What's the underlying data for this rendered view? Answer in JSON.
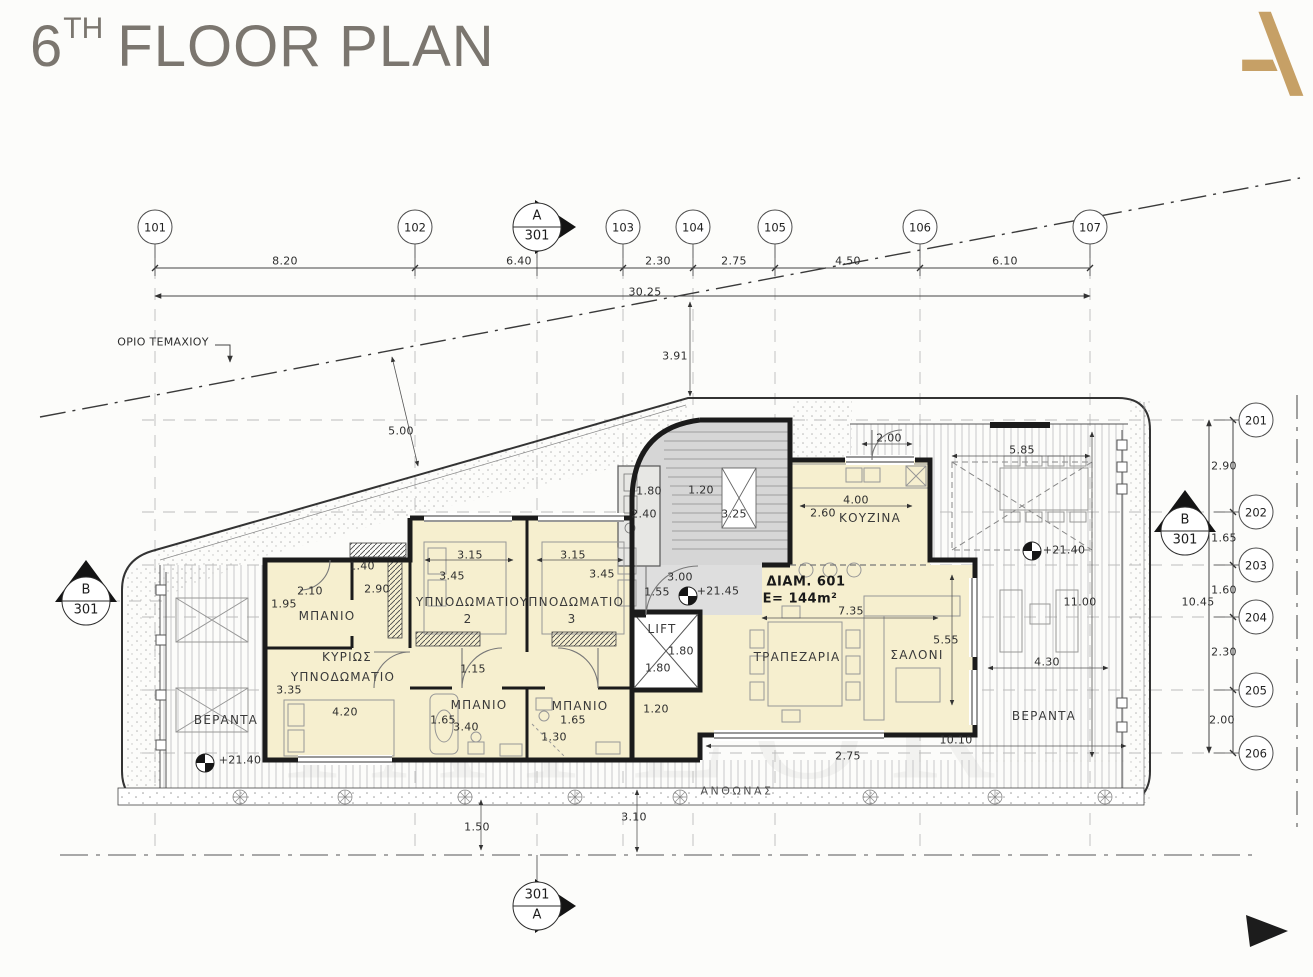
{
  "title": {
    "number": "6",
    "ordinal": "TH",
    "rest": "FLOOR PLAN"
  },
  "logo": {
    "letter": "A",
    "color": "#c6a066"
  },
  "colors": {
    "room_fill": "#f6efcf",
    "stair_fill": "#d6d6d6",
    "wall": "#1b1b1b",
    "accent_gold": "#c6a066",
    "title_gray": "#7b766f"
  },
  "watermark": "TAYLOR",
  "apartment": {
    "id": "ΔΙΑΜ. 601",
    "area": "E=  144m²"
  },
  "grid": {
    "top": [
      {
        "id": "101",
        "x": 155
      },
      {
        "id": "102",
        "x": 415
      },
      {
        "id": "103",
        "x": 623
      },
      {
        "id": "104",
        "x": 693
      },
      {
        "id": "105",
        "x": 775
      },
      {
        "id": "106",
        "x": 920
      },
      {
        "id": "107",
        "x": 1090
      }
    ],
    "right": [
      {
        "id": "201",
        "y": 420
      },
      {
        "id": "202",
        "y": 512
      },
      {
        "id": "203",
        "y": 565
      },
      {
        "id": "204",
        "y": 617
      },
      {
        "id": "205",
        "y": 690
      },
      {
        "id": "206",
        "y": 753
      }
    ]
  },
  "markers": [
    {
      "top": "A",
      "bottom": "301",
      "x": 537,
      "y": 227,
      "dir": "right"
    },
    {
      "top": "B",
      "bottom": "301",
      "x": 86,
      "y": 601,
      "dir": "up"
    },
    {
      "top": "B",
      "bottom": "301",
      "x": 1185,
      "y": 531,
      "dir": "up"
    },
    {
      "top": "301",
      "bottom": "A",
      "x": 537,
      "y": 906,
      "dir": "right"
    }
  ],
  "icons": {
    "plant": "flower-rosette",
    "level_mark": "quartered-circle",
    "corner_arrow": "black-triangle"
  },
  "labels": [
    {
      "t": "8.20",
      "x": 285,
      "y": 261
    },
    {
      "t": "6.40",
      "x": 519,
      "y": 261
    },
    {
      "t": "2.30",
      "x": 658,
      "y": 261
    },
    {
      "t": "2.75",
      "x": 734,
      "y": 261
    },
    {
      "t": "4.50",
      "x": 848,
      "y": 261
    },
    {
      "t": "6.10",
      "x": 1005,
      "y": 261
    },
    {
      "t": "30.25",
      "x": 645,
      "y": 292
    },
    {
      "n": "boundary-label",
      "t": "ΟΡΙΟ ΤΕΜΑΧΙΟΥ",
      "x": 163,
      "y": 342
    },
    {
      "t": "3.91",
      "x": 675,
      "y": 356
    },
    {
      "t": "5.00",
      "x": 401,
      "y": 431
    },
    {
      "t": "2.00",
      "x": 889,
      "y": 438
    },
    {
      "t": "5.85",
      "x": 1022,
      "y": 450
    },
    {
      "t": "1.80",
      "x": 649,
      "y": 491
    },
    {
      "t": "1.20",
      "x": 701,
      "y": 490
    },
    {
      "t": "2.40",
      "x": 644,
      "y": 514
    },
    {
      "t": "3.25",
      "x": 734,
      "y": 514
    },
    {
      "t": "4.00",
      "x": 856,
      "y": 500
    },
    {
      "t": "2.60",
      "x": 823,
      "y": 513
    },
    {
      "t": "ΚΟΥΖΙΝΑ",
      "x": 870,
      "y": 518,
      "k": "r"
    },
    {
      "t": "1.40",
      "x": 362,
      "y": 566
    },
    {
      "t": "3.15",
      "x": 470,
      "y": 555
    },
    {
      "t": "3.45",
      "x": 452,
      "y": 576
    },
    {
      "t": "3.15",
      "x": 573,
      "y": 555
    },
    {
      "t": "3.45",
      "x": 602,
      "y": 574
    },
    {
      "t": "2.90",
      "x": 377,
      "y": 589
    },
    {
      "t": "2.10",
      "x": 310,
      "y": 591
    },
    {
      "t": "1.95",
      "x": 284,
      "y": 604
    },
    {
      "t": "ΜΠΑΝΙΟ",
      "x": 327,
      "y": 616,
      "k": "r"
    },
    {
      "t": "3.00",
      "x": 680,
      "y": 577
    },
    {
      "t": "1.55",
      "x": 657,
      "y": 592
    },
    {
      "t": "+21.45",
      "x": 718,
      "y": 591
    },
    {
      "n": "apartment-id",
      "t": "ΔΙΑΜ. 601",
      "x": 806,
      "y": 582,
      "k": "b"
    },
    {
      "n": "apartment-area",
      "t": "E=  144m²",
      "x": 800,
      "y": 599,
      "k": "b"
    },
    {
      "t": "ΥΠΝΟΔΩΜΑΤΙΟ",
      "x": 468,
      "y": 602,
      "k": "r"
    },
    {
      "t": "2",
      "x": 468,
      "y": 619,
      "k": "r"
    },
    {
      "t": "ΥΠΝΟΔΩΜΑΤΙΟ",
      "x": 572,
      "y": 602,
      "k": "r"
    },
    {
      "t": "3",
      "x": 572,
      "y": 619,
      "k": "r"
    },
    {
      "t": "7.35",
      "x": 851,
      "y": 611
    },
    {
      "t": "5.55",
      "x": 946,
      "y": 640
    },
    {
      "t": "ΣΑΛΟΝΙ",
      "x": 917,
      "y": 655,
      "k": "r"
    },
    {
      "t": "ΤΡΑΠΕΖΑΡΙΑ",
      "x": 797,
      "y": 657,
      "k": "r"
    },
    {
      "t": "LIFT",
      "x": 662,
      "y": 629,
      "k": "r"
    },
    {
      "t": "1.80",
      "x": 681,
      "y": 651
    },
    {
      "t": "1.80",
      "x": 658,
      "y": 668
    },
    {
      "t": "ΚΥΡΙΩΣ",
      "x": 347,
      "y": 657,
      "k": "r"
    },
    {
      "t": "ΥΠΝΟΔΩΜΑΤΙΟ",
      "x": 343,
      "y": 677,
      "k": "r"
    },
    {
      "t": "3.35",
      "x": 289,
      "y": 690
    },
    {
      "t": "1.15",
      "x": 473,
      "y": 669
    },
    {
      "t": "11.00",
      "x": 1080,
      "y": 602
    },
    {
      "t": "10.45",
      "x": 1198,
      "y": 602
    },
    {
      "t": "4.30",
      "x": 1047,
      "y": 662
    },
    {
      "t": "ΒΕΡΑΝΤΑ",
      "x": 1044,
      "y": 716,
      "k": "r"
    },
    {
      "t": "4.20",
      "x": 345,
      "y": 712
    },
    {
      "t": "ΜΠΑΝΙΟ",
      "x": 479,
      "y": 705,
      "k": "r"
    },
    {
      "t": "1.65",
      "x": 443,
      "y": 720
    },
    {
      "t": "3.40",
      "x": 466,
      "y": 727
    },
    {
      "t": "ΜΠΑΝΙΟ",
      "x": 580,
      "y": 706,
      "k": "r"
    },
    {
      "t": "1.65",
      "x": 573,
      "y": 720
    },
    {
      "t": "1.30",
      "x": 554,
      "y": 737
    },
    {
      "t": "1.20",
      "x": 656,
      "y": 709
    },
    {
      "t": "2.75",
      "x": 848,
      "y": 756
    },
    {
      "t": "10.10",
      "x": 956,
      "y": 740
    },
    {
      "t": "ΒΕΡΑΝΤΑ",
      "x": 226,
      "y": 720,
      "k": "r"
    },
    {
      "t": "+21.40",
      "x": 240,
      "y": 760
    },
    {
      "t": "+21.40",
      "x": 1064,
      "y": 550
    },
    {
      "n": "planter-label",
      "t": "ΑΝΘΩΝΑΣ",
      "x": 737,
      "y": 791,
      "k": "p"
    },
    {
      "t": "1.50",
      "x": 477,
      "y": 827
    },
    {
      "t": "3.10",
      "x": 634,
      "y": 817
    },
    {
      "t": "2.90",
      "x": 1224,
      "y": 466
    },
    {
      "t": "1.65",
      "x": 1224,
      "y": 538
    },
    {
      "t": "1.60",
      "x": 1224,
      "y": 590
    },
    {
      "t": "2.30",
      "x": 1224,
      "y": 652
    },
    {
      "t": "2.00",
      "x": 1222,
      "y": 720
    }
  ]
}
